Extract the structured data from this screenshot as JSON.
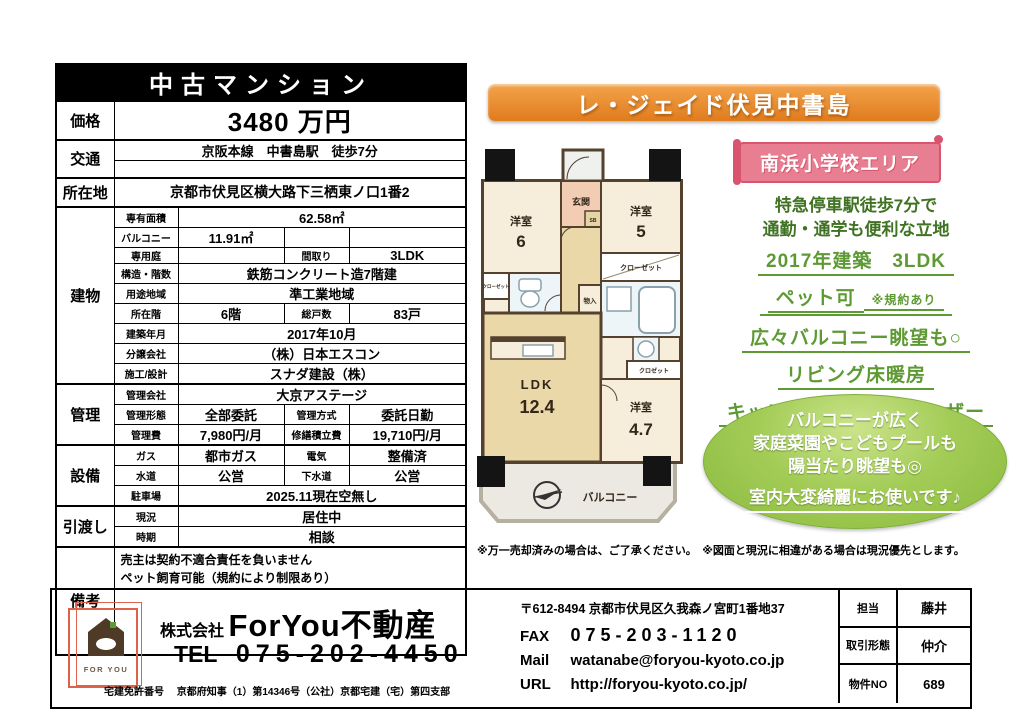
{
  "colors": {
    "banner_orange": "#e8872e",
    "banner_pink": "#e87e92",
    "catch_green": "#3f7222",
    "feature_green": "#5e9a33",
    "oval_green": "#8fbe44"
  },
  "table": {
    "title": "中古マンション",
    "price": {
      "label": "価格",
      "value": "3480 万円"
    },
    "access": {
      "label": "交通",
      "line1": "京阪本線　中書島駅　徒歩7分"
    },
    "location": {
      "label": "所在地",
      "value": "京都市伏見区横大路下三栖東ノ口1番2"
    },
    "building": {
      "label": "建物",
      "area_label": "専有面積",
      "area_value": "62.58㎡",
      "balcony_label": "バルコニー",
      "balcony_value": "11.91㎡",
      "garden_label": "専用庭",
      "layout_label": "間取り",
      "layout_value": "3LDK",
      "structure_label": "構造・階数",
      "structure_value": "鉄筋コンクリート造7階建",
      "zoning_label": "用途地域",
      "zoning_value": "準工業地域",
      "floor_label": "所在階",
      "floor_value": "6階",
      "units_label": "総戸数",
      "units_value": "83戸",
      "built_label": "建築年月",
      "built_value": "2017年10月",
      "seller_label": "分譲会社",
      "seller_value": "（株）日本エスコン",
      "builder_label": "施工/設計",
      "builder_value": "スナダ建設（株）"
    },
    "management": {
      "label": "管理",
      "company_label": "管理会社",
      "company_value": "大京アステージ",
      "form_label": "管理形態",
      "form_value": "全部委託",
      "method_label": "管理方式",
      "method_value": "委託日勤",
      "fee_label": "管理費",
      "fee_value": "7,980円/月",
      "reserve_label": "修繕積立費",
      "reserve_value": "19,710円/月"
    },
    "facilities": {
      "label": "設備",
      "gas_label": "ガス",
      "gas_value": "都市ガス",
      "electric_label": "電気",
      "electric_value": "整備済",
      "water_label": "水道",
      "water_value": "公営",
      "sewer_label": "下水道",
      "sewer_value": "公営",
      "parking_label": "駐車場",
      "parking_value": "2025.11現在空無し"
    },
    "handover": {
      "label": "引渡し",
      "status_label": "現況",
      "status_value": "居住中",
      "timing_label": "時期",
      "timing_value": "相談"
    },
    "remarks": {
      "label": "備考",
      "line1": "売主は契約不適合責任を負いません",
      "line2": "ペット飼育可能（規約により制限あり）"
    }
  },
  "promo": {
    "title": "レ・ジェイド伏見中書島",
    "school_area": "南浜小学校エリア",
    "catch_line1": "特急停車駅徒歩7分で",
    "catch_line2": "通勤・通学も便利な立地",
    "features": [
      "2017年建築　3LDK",
      "ペット可",
      "広々バルコニー眺望も○",
      "リビング床暖房",
      "キッチンにはディスポーザー"
    ],
    "pet_note": "※規約あり",
    "oval_line1": "バルコニーが広く",
    "oval_line2": "家庭菜園やこどもプールも",
    "oval_line3": "陽当たり眺望も◎",
    "oval_line4": "室内大変綺麗にお使いです♪",
    "disclaimer": "※万一売却済みの場合は、ご了承ください。　※図面と現況に相違がある場合は現況優先とします。"
  },
  "floorplan": {
    "entrance": "玄関",
    "sb": "SB",
    "room1_name": "洋室",
    "room1_size": "6",
    "room2_name": "洋室",
    "room2_size": "5",
    "closet1": "クローゼット",
    "closet2": "クローゼット",
    "storage": "物入",
    "ldk_name": "LDK",
    "ldk_size": "12.4",
    "room3_name": "洋室",
    "room3_size": "4.7",
    "closet3": "クロゼット",
    "balcony": "バルコニー"
  },
  "footer": {
    "logo_text": "FOR YOU",
    "company_prefix": "株式会社",
    "company_name": "ForYou不動産",
    "tel_label": "TEL",
    "tel": "075-202-4450",
    "license_label": "宅建免許番号",
    "license_value": "京都府知事（1）第14346号（公社）京都宅建（宅）第四支部",
    "postal": "〒612-8494 京都市伏見区久我森ノ宮町1番地37",
    "fax_label": "FAX",
    "fax": "075-203-1120",
    "mail_label": "Mail",
    "mail": "watanabe@foryou-kyoto.co.jp",
    "url_label": "URL",
    "url": "http://foryou-kyoto.co.jp/",
    "rep_label": "担当",
    "rep_value": "藤井",
    "deal_label": "取引形態",
    "deal_value": "仲介",
    "no_label": "物件NO",
    "no_value": "689"
  }
}
